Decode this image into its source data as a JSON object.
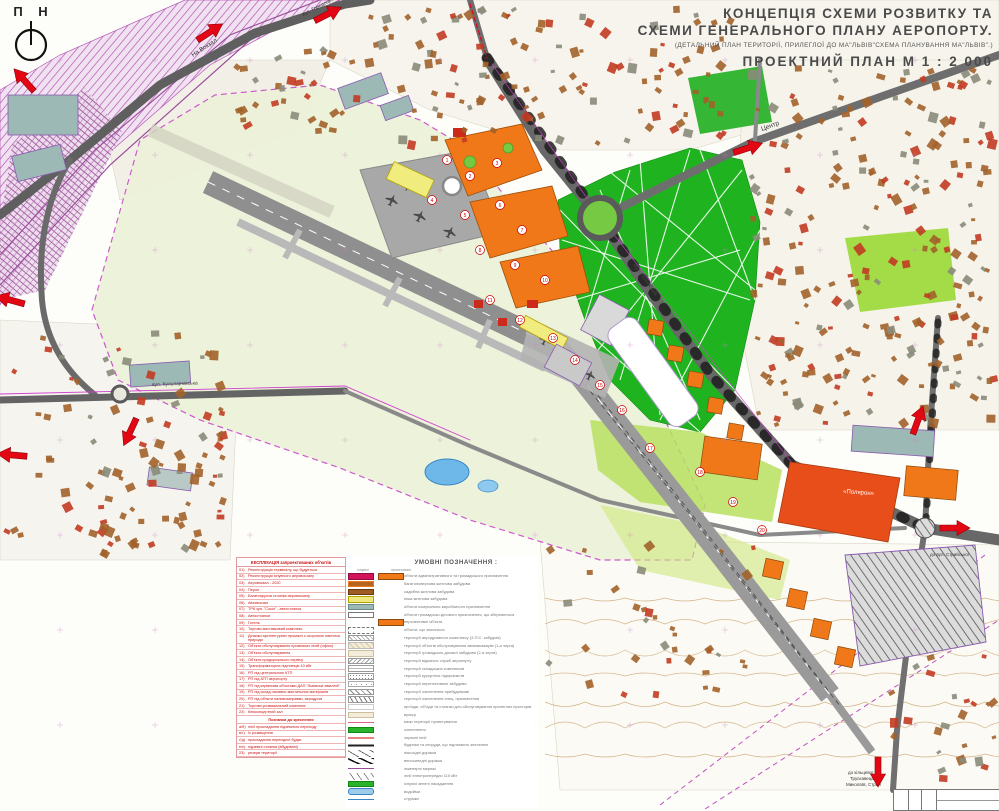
{
  "title_block": {
    "line1": "КОНЦЕПЦІЯ СХЕМИ РОЗВИТКУ ТА",
    "line2": "СХЕМИ ГЕНЕРАЛЬНОГО ПЛАНУ АЕРОПОРТУ.",
    "line3": "(ДЕТАЛЬНИЙ ПЛАН ТЕРИТОРІЇ, ПРИЛЕГЛОЇ ДО МА\"ЛЬВІВ\"СХЕМА ПЛАНУВАННЯ МА\"ЛЬВІВ\".)",
    "line4": "ПРОЕКТНИЙ ПЛАН М 1 : 2 000"
  },
  "compass": {
    "label": "П Н"
  },
  "colors": {
    "accent_red": "#e30613",
    "park_green": "#1fb41f",
    "meadow_green": "#a4dc48",
    "field_green": "#edf2da",
    "orange_project": "#f07818",
    "yellow_building": "#f1ec7e",
    "teal_industrial": "#9db9b5",
    "railway_violet": "#b455b4",
    "runway_gray": "#8f8f8f"
  },
  "map_labels": [
    {
      "text": "На Вокзал",
      "x": 193,
      "y": 57,
      "rot": -33,
      "size": 6,
      "color": "#333"
    },
    {
      "text": "вул. Городоцька",
      "x": 303,
      "y": 16,
      "rot": -27,
      "size": 5,
      "color": "#333"
    },
    {
      "text": "Центр",
      "x": 762,
      "y": 131,
      "rot": -20,
      "size": 6.5,
      "color": "#333"
    },
    {
      "text": "вул. Любінська",
      "x": 633,
      "y": 265,
      "rot": 54,
      "size": 5.5,
      "color": "#444"
    },
    {
      "text": "вул. Кульпарківська",
      "x": 152,
      "y": 386,
      "rot": -2,
      "size": 5,
      "color": "#444"
    },
    {
      "text": "«Полярон»",
      "x": 843,
      "y": 493,
      "rot": 4,
      "size": 6,
      "color": "#ffffff"
    },
    {
      "text": "до вул. Стрийської",
      "x": 930,
      "y": 556,
      "rot": 0,
      "size": 4.5,
      "color": "#333"
    },
    {
      "text": "до кільцевої",
      "x": 848,
      "y": 774,
      "rot": 0,
      "size": 4.5,
      "color": "#333"
    },
    {
      "text": "Трускавець,",
      "x": 850,
      "y": 780,
      "rot": 0,
      "size": 4.5,
      "color": "#333"
    },
    {
      "text": "Миколаїв, Стрий",
      "x": 846,
      "y": 786,
      "rot": 0,
      "size": 4.5,
      "color": "#333"
    }
  ],
  "site_numbers": [
    {
      "n": "1",
      "x": 447,
      "y": 160
    },
    {
      "n": "2",
      "x": 470,
      "y": 176
    },
    {
      "n": "3",
      "x": 497,
      "y": 163
    },
    {
      "n": "4",
      "x": 432,
      "y": 200
    },
    {
      "n": "5",
      "x": 465,
      "y": 215
    },
    {
      "n": "6",
      "x": 500,
      "y": 205
    },
    {
      "n": "7",
      "x": 522,
      "y": 230
    },
    {
      "n": "8",
      "x": 480,
      "y": 250
    },
    {
      "n": "9",
      "x": 515,
      "y": 265
    },
    {
      "n": "10",
      "x": 545,
      "y": 280
    },
    {
      "n": "11",
      "x": 490,
      "y": 300
    },
    {
      "n": "12",
      "x": 520,
      "y": 320
    },
    {
      "n": "13",
      "x": 553,
      "y": 338
    },
    {
      "n": "14",
      "x": 575,
      "y": 360
    },
    {
      "n": "15",
      "x": 600,
      "y": 385
    },
    {
      "n": "16",
      "x": 622,
      "y": 410
    },
    {
      "n": "17",
      "x": 650,
      "y": 448
    },
    {
      "n": "18",
      "x": 700,
      "y": 472
    },
    {
      "n": "19",
      "x": 733,
      "y": 502
    },
    {
      "n": "20",
      "x": 762,
      "y": 530
    }
  ],
  "legend": {
    "title": "УМОВНІ ПОЗНАЧЕННЯ :",
    "col_existing": "існуючі",
    "col_projected": "проектовані",
    "items": [
      {
        "swatch": "red",
        "swatch2": "orange",
        "label": "об'єкти адміністративного та громадського призначення"
      },
      {
        "swatch": "brownOutline",
        "label": "багатоповерхова житлова забудова"
      },
      {
        "swatch": "brown",
        "label": "садибна житлова забудова"
      },
      {
        "swatch": "yellow",
        "label": "інша житлова забудова"
      },
      {
        "swatch": "teal",
        "label": "об'єкти комунально-виробничого призначення"
      },
      {
        "swatch": "outline",
        "label": "об'єкти громадсько-ділового призначення, що зберігаються"
      },
      {
        "swatch": "none",
        "swatch2": "orange",
        "label": "перспективні об'єкти"
      },
      {
        "swatch": "dashedBox",
        "label": "об'єкти, що зносяться"
      },
      {
        "swatch": "grayHatch",
        "label": "території аеродромного комплексу (З.П.С. забудові)"
      },
      {
        "swatch": "creamHatch",
        "label": "території об'єктів обслуговування авіапасажирів (1-а черга)"
      },
      {
        "swatch": "cream",
        "label": "території громадсько-ділової забудови (2-а черга)"
      },
      {
        "swatch": "zigzag",
        "label": "території відомчих служб аеропорту"
      },
      {
        "swatch": "brick",
        "label": "території складських комплексів"
      },
      {
        "swatch": "dots",
        "label": "території курортних підприємств"
      },
      {
        "swatch": "dotsSparse",
        "label": "території перспективної забудови"
      },
      {
        "swatch": "diag",
        "label": "території озеленення прибудинкові"
      },
      {
        "swatch": "diagSteep",
        "label": "території озеленення спец. призначення"
      },
      {
        "swatch": "blank",
        "label": "проїзди, об'їзди та стоянки для обслуговування прилеглих просторів"
      },
      {
        "swatch": "cream",
        "label": "вулиці"
      },
      {
        "swatch": "pinkLine",
        "label": "межі території проектування"
      },
      {
        "swatch": "greenSolid",
        "label": "озеленення"
      },
      {
        "swatch": "dblRed",
        "label": "червоні лінії"
      },
      {
        "swatch": "blackLine",
        "label": "будинки та споруди, що підлягають знесенню"
      },
      {
        "swatch": "thinDiag",
        "label": "пішохідні доріжки"
      },
      {
        "swatch": "blackDiag",
        "label": "велосипедні доріжки"
      },
      {
        "swatch": "purpleLine",
        "label": "інженерні мережі"
      },
      {
        "swatch": "steepThin",
        "label": "лінії електропередач 110 кВт"
      },
      {
        "swatch": "greenSolid",
        "label": "існуючі зелені насадження"
      },
      {
        "swatch": "water",
        "label": "водойми"
      },
      {
        "swatch": "blueLine",
        "label": "струмки"
      }
    ]
  },
  "explication": {
    "title": "ЕКСПЛІКАЦІЯ запроектованих об'єктів",
    "rows": [
      {
        "num": "01",
        "text": "Реконструкція терміналу, що будується"
      },
      {
        "num": "02",
        "text": "Реконструкція існуючого аеровокзалу"
      },
      {
        "num": "03",
        "text": "Аеровокзал - 2020"
      },
      {
        "num": "04",
        "text": "Перон"
      },
      {
        "num": "05",
        "text": "Багатоярусна стоянка аеровокзалу"
      },
      {
        "num": "06",
        "text": "Автовокзал"
      },
      {
        "num": "07",
        "text": "ТРК зуп. \"Сокіл\" - автостоянка"
      },
      {
        "num": "08",
        "text": "Автостоянки"
      },
      {
        "num": "09",
        "text": "Готель"
      },
      {
        "num": "10",
        "text": "Торгово-виставковий комплекс"
      },
      {
        "num": "11",
        "text": "Ділянки архітектурних промзон з охороною пам'яток природи"
      },
      {
        "num": "12",
        "text": "Об'єкти обслуговування приземних ліній (офіси)"
      },
      {
        "num": "13",
        "text": "Об'єкти обслуговування"
      },
      {
        "num": "14",
        "text": "Об'єкти придорожнього сервісу"
      },
      {
        "num": "15",
        "text": "Трансформаторна підстанція 10 кВт"
      },
      {
        "num": "16",
        "text": "РП під центральною КТП"
      },
      {
        "num": "17",
        "text": "РП під АТП аеропорту"
      },
      {
        "num": "18",
        "text": "РП під керівними об'єктами ДАП \"Львівські авіалінії\""
      },
      {
        "num": "19",
        "text": "РП під склад паливно-мастильних матеріалів"
      },
      {
        "num": "20",
        "text": "РП під об'єкти паливозаправки, аеродром"
      },
      {
        "num": "21",
        "text": "Торгово-розважальний комплекс"
      },
      {
        "num": "22",
        "text": "Кіноконцертний зал"
      }
    ],
    "subtitle": "Позначки до креслення",
    "extra_rows": [
      {
        "num": "а/б",
        "text": "лінії прокладання підземного переходу"
      },
      {
        "num": "в/г",
        "text": "їх розміщення"
      },
      {
        "num": "ґ/д",
        "text": "прокладання перехідної будки"
      },
      {
        "num": "е/є",
        "text": "підземні стоянки (вбудовані)"
      },
      {
        "num": "23",
        "text": "резерв території"
      }
    ]
  }
}
